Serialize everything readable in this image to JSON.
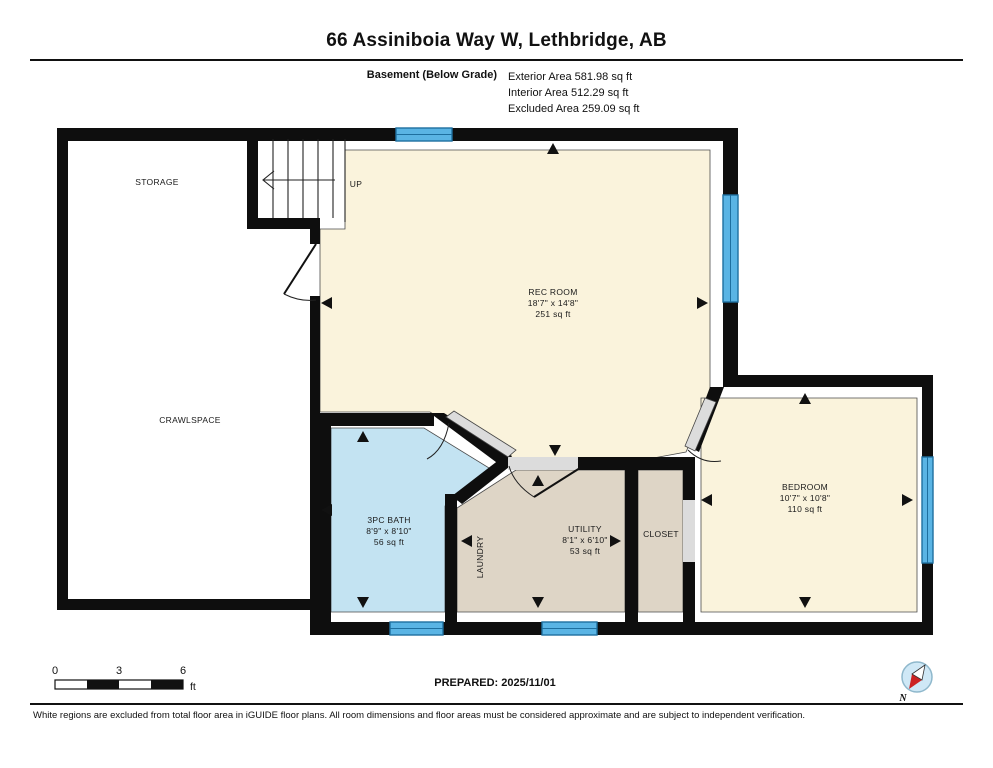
{
  "header": {
    "title": "66 Assiniboia Way W, Lethbridge, AB",
    "floor_label": "Basement (Below Grade)",
    "areas": [
      "Exterior Area 581.98 sq ft",
      "Interior Area 512.29 sq ft",
      "Excluded Area 259.09 sq ft"
    ]
  },
  "rooms": {
    "storage": {
      "name": "STORAGE"
    },
    "crawlspace": {
      "name": "CRAWLSPACE"
    },
    "rec": {
      "name": "REC ROOM",
      "dims": "18'7\" x 14'8\"",
      "area": "251 sq ft"
    },
    "bath": {
      "name": "3PC BATH",
      "dims": "8'9\" x 8'10\"",
      "area": "56 sq ft"
    },
    "laundry": {
      "name": "LAUNDRY"
    },
    "utility": {
      "name": "UTILITY",
      "dims": "8'1\" x 6'10\"",
      "area": "53 sq ft"
    },
    "closet": {
      "name": "CLOSET"
    },
    "bedroom": {
      "name": "BEDROOM",
      "dims": "10'7\" x 10'8\"",
      "area": "110 sq ft"
    }
  },
  "stairs": {
    "up_label": "UP"
  },
  "scale_bar": {
    "ticks": [
      "0",
      "3",
      "6"
    ],
    "unit": "ft"
  },
  "prepared": "PREPARED: 2025/11/01",
  "compass": {
    "n_label": "N"
  },
  "footer": {
    "disclaimer": "White regions are excluded from total floor area in iGUIDE floor plans. All room dimensions and floor areas must be considered approximate and are subject to independent verification."
  },
  "colors": {
    "wall": "#0e0e0e",
    "room": "#faf3dc",
    "bath": "#c3e3f2",
    "service": "#ded5c6",
    "window_fill": "#5ab4e4",
    "window_edge": "#1e6f9f",
    "door": "#dcdcdc",
    "compass_face": "#cfe8f6",
    "compass_red": "#cc2222"
  }
}
